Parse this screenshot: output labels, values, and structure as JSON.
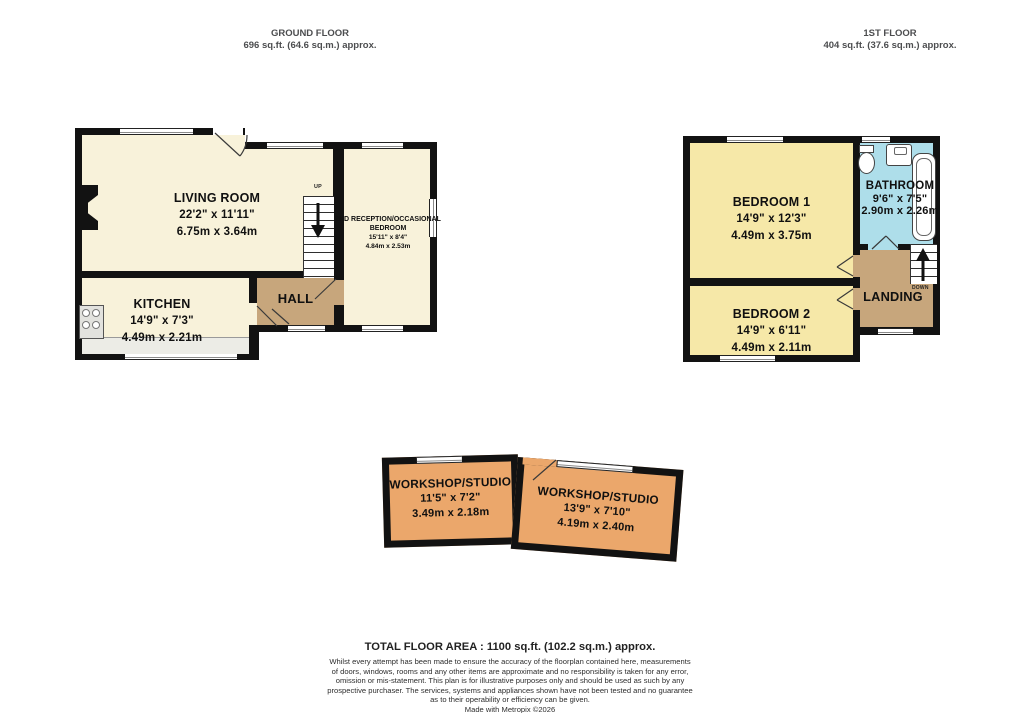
{
  "ground_floor": {
    "title": "GROUND FLOOR",
    "area": "696 sq.ft. (64.6 sq.m.) approx.",
    "stairs_label": "UP",
    "rooms": {
      "living_room": {
        "name": "LIVING ROOM",
        "imperial": "22'2\" x 11'11\"",
        "metric": "6.75m x 3.64m"
      },
      "kitchen": {
        "name": "KITCHEN",
        "imperial": "14'9\" x 7'3\"",
        "metric": "4.49m x 2.21m"
      },
      "hall": {
        "name": "HALL"
      },
      "reception": {
        "name_line1": "2ND RECEPTION/OCCASIONAL",
        "name_line2": "BEDROOM",
        "imperial": "15'11\" x 8'4\"",
        "metric": "4.84m x 2.53m"
      }
    }
  },
  "first_floor": {
    "title": "1ST FLOOR",
    "area": "404 sq.ft. (37.6 sq.m.) approx.",
    "stairs_label": "DOWN",
    "rooms": {
      "bedroom1": {
        "name": "BEDROOM 1",
        "imperial": "14'9\" x 12'3\"",
        "metric": "4.49m x 3.75m"
      },
      "bedroom2": {
        "name": "BEDROOM 2",
        "imperial": "14'9\" x 6'11\"",
        "metric": "4.49m x 2.11m"
      },
      "bathroom": {
        "name": "BATHROOM",
        "imperial": "9'6\" x 7'5\"",
        "metric": "2.90m x 2.26m"
      },
      "landing": {
        "name": "LANDING"
      }
    }
  },
  "outbuildings": {
    "workshop_left": {
      "name": "WORKSHOP/STUDIO",
      "imperial": "11'5\" x 7'2\"",
      "metric": "3.49m x 2.18m"
    },
    "workshop_right": {
      "name": "WORKSHOP/STUDIO",
      "imperial": "13'9\" x 7'10\"",
      "metric": "4.19m x 2.40m"
    }
  },
  "footer": {
    "total_area": "TOTAL FLOOR AREA : 1100 sq.ft. (102.2 sq.m.) approx.",
    "disclaimer_lines": [
      "Whilst every attempt has been made to ensure the accuracy of the floorplan contained here, measurements",
      "of doors, windows, rooms and any other items are approximate and no responsibility is taken for any error,",
      "omission or mis-statement. This plan is for illustrative purposes only and should be used as such by any",
      "prospective purchaser. The services, systems and appliances shown have not been tested and no guarantee",
      "as to their operability or efficiency can be given.",
      "Made with Metropix ©2026"
    ]
  },
  "colors": {
    "room_cream": "#F8F2DA",
    "room_yellow": "#F6E8A8",
    "room_blue": "#AEDEEA",
    "hall_brown": "#C7A67C",
    "workshop_orange": "#EBA76B",
    "wall_black": "#121212"
  }
}
